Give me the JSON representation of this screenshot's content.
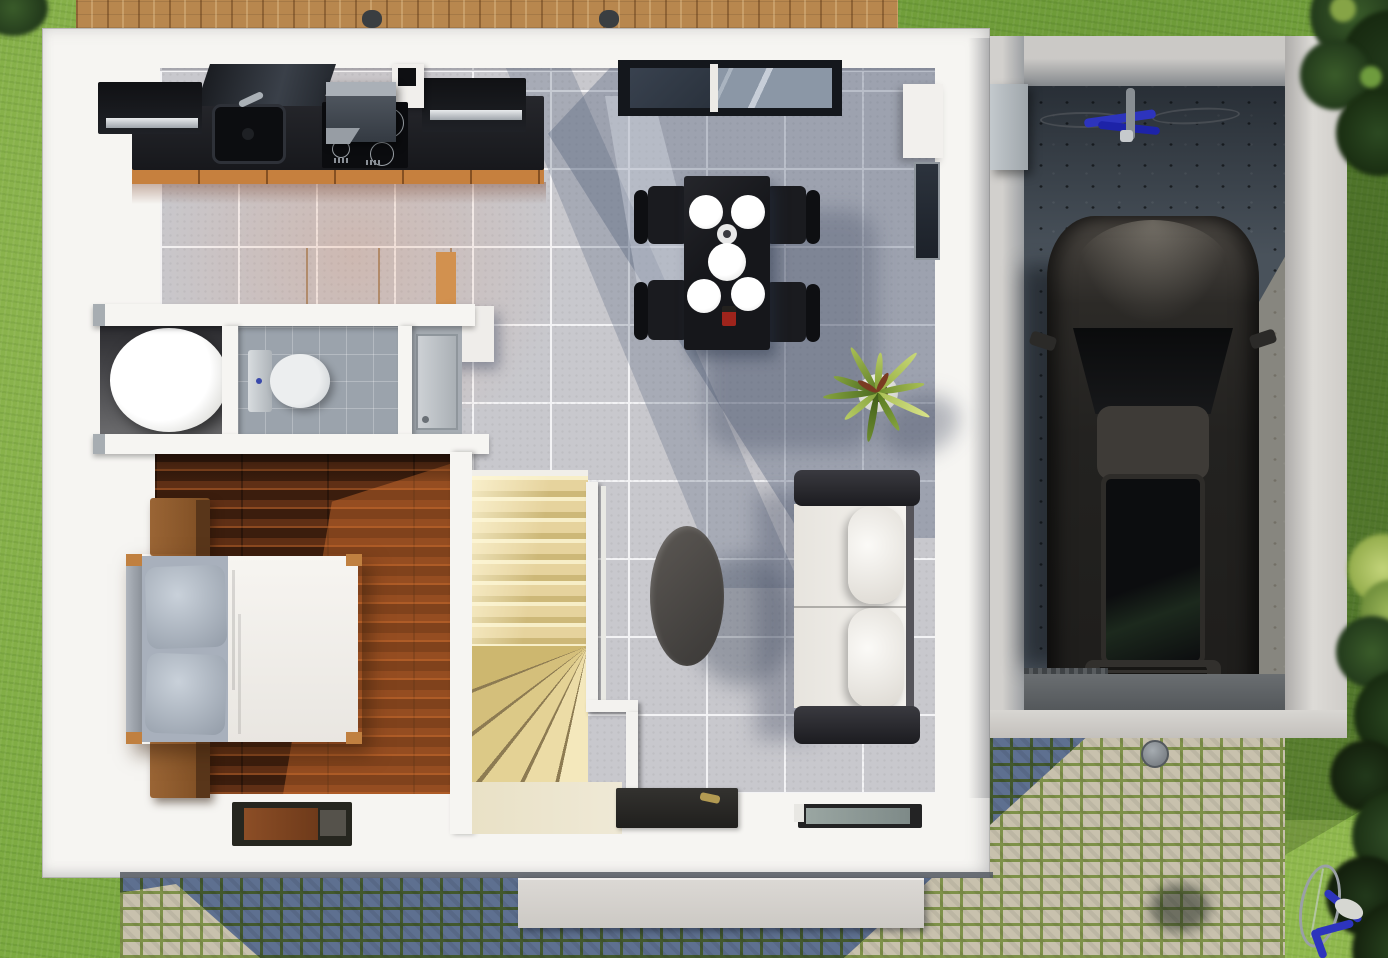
{
  "scene": {
    "type": "3d-floor-plan-render",
    "view": "top-down",
    "description": "Rendered first-floor plan of a small modern house with attached single garage, lawn, wooden deck and cobblestone driveway",
    "width_px": 1388,
    "height_px": 958
  },
  "labels": {
    "scene": "3D floor plan render, top-down view",
    "yard": "lawn and garden",
    "deck": "wooden terrace deck",
    "house": "house first floor",
    "kitchen": "kitchen with black counter and orange cabinets",
    "dining": "dining area with black table and four chairs",
    "living": "living area with white sofa and coffee table",
    "bathroom": "bathroom with toilet and round tub",
    "bedroom": "bedroom with double bed and nightstands",
    "stairs": "winder staircase with white railing",
    "hallway": "entrance hallway with door mats",
    "garage": "garage with parked car and bicycle",
    "driveway": "cobblestone driveway",
    "car": "dark gray car parked in garage",
    "bicycle_garage": "blue bicycle lying on garage floor",
    "bicycle_yard": "blue bicycle standing in back yard",
    "plant": "potted spiky green plant",
    "window": "black framed window on top wall",
    "trees": "dark green trees and bushes"
  },
  "rooms": [
    {
      "name": "Kitchen",
      "features": [
        "black countertop",
        "sink",
        "cooktop with range hood",
        "orange base cabinets",
        "orange island"
      ]
    },
    {
      "name": "Dining area",
      "features": [
        "black table",
        "4 black chairs",
        "4 white plates",
        "white serving bowl",
        "red candle"
      ]
    },
    {
      "name": "Living area",
      "features": [
        "white sofa with black frame",
        "dark oval coffee table",
        "potted plant"
      ]
    },
    {
      "name": "Bathroom",
      "features": [
        "round white tub",
        "toilet",
        "gray tile floor"
      ]
    },
    {
      "name": "Bedroom",
      "features": [
        "double bed with white duvet",
        "2 wooden nightstands",
        "dark wood plank floor",
        "door mat"
      ]
    },
    {
      "name": "Staircase",
      "features": [
        "cream winder stairs",
        "white railing"
      ]
    },
    {
      "name": "Garage",
      "features": [
        "concrete floor",
        "dark gray car",
        "blue bicycle",
        "utility cabinet",
        "entry ramp"
      ]
    }
  ],
  "colors": {
    "grass": "#7caa41",
    "grass-dark": "#4c7a28",
    "tree-dark": "#22391b",
    "tree-mid": "#3a5c2a",
    "tree-light": "#9db85a",
    "deck": "#b8874e",
    "wall": "#f6f5f2",
    "tile": "#c8c8cd",
    "tile-grout": "#f3f3f5",
    "counter": "#1b1d22",
    "cabinet-orange": "#c6803e",
    "island": "#f2b678",
    "island-side": "#d2914f",
    "bath-tile": "#9ba3ac",
    "wood": "#5f2f15",
    "wood-lit": "#c96f34",
    "stair": "#e6d39d",
    "stair-lit": "#f7eec7",
    "stair-shade": "#cdb878",
    "rail": "#f3f2ef",
    "sofa-frame": "#232327",
    "cushion": "#f1efe9",
    "table": "#16171b",
    "plate": "#ffffff",
    "concrete": "#49525b",
    "garage-wall": "#c7c5c2",
    "car": "#262522",
    "car-glass": "#0e0f11",
    "cobble-stone": "#5e7090",
    "cobble-grout": "#42582e",
    "cobble-stone-lit": "#c8c1ad",
    "cobble-grout-lit": "#7e9149",
    "ramp": "#5a5e62",
    "step": "#d9d6d1",
    "bike-blue": "#2d34bd",
    "gold": "#b29a52",
    "red": "#9e241c"
  }
}
